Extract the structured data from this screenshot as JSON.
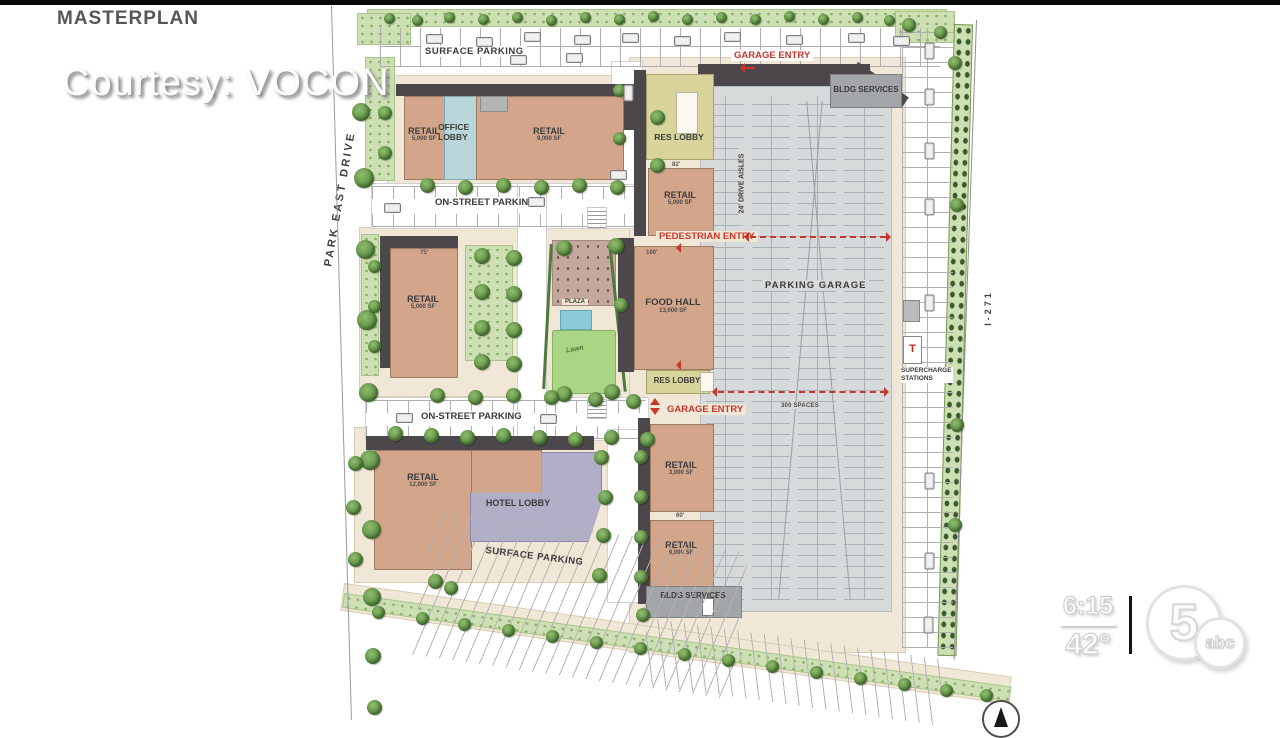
{
  "broadcast": {
    "title": "MASTERPLAN",
    "courtesy": "Courtesy: VOCON",
    "time": "6:15",
    "temperature": "42°",
    "station": {
      "channel": "5",
      "network": "abc"
    }
  },
  "plan": {
    "streets": {
      "west": "PARK EAST DRIVE",
      "east": "I-271"
    },
    "labels": {
      "surface_parking_top": "SURFACE PARKING",
      "surface_parking_bottom": "SURFACE PARKING",
      "on_street_parking_upper": "ON-STREET PARKING",
      "on_street_parking_lower": "ON-STREET PARKING",
      "parking_garage": "PARKING GARAGE",
      "drive_aisles": "24' DRIVE AISLES",
      "spaces": "300 SPACES",
      "supercharge_line1": "SUPERCHARGE",
      "supercharge_line2": "STATIONS",
      "plaza": "PLAZA",
      "lawn": "Lawn"
    },
    "entries": {
      "garage_top": "GARAGE ENTRY",
      "garage_mid": "GARAGE ENTRY",
      "pedestrian": "PEDESTRIAN ENTRY"
    },
    "buildings": {
      "retail_nw": {
        "name": "RETAIL",
        "area": "5,000 SF"
      },
      "office_lobby": {
        "name": "OFFICE LOBBY"
      },
      "retail_ne": {
        "name": "RETAIL",
        "area": "9,000 SF"
      },
      "res_lobby_top": {
        "name": "RES LOBBY"
      },
      "retail_e": {
        "name": "RETAIL",
        "area": "5,000 SF"
      },
      "retail_w": {
        "name": "RETAIL",
        "area": "5,000 SF"
      },
      "food_hall": {
        "name": "FOOD HALL",
        "area": "13,000 SF"
      },
      "res_lobby_mid": {
        "name": "RES LOBBY"
      },
      "retail_s1": {
        "name": "RETAIL",
        "area": "3,000 SF"
      },
      "retail_s2": {
        "name": "RETAIL",
        "area": "9,000 SF"
      },
      "retail_sw": {
        "name": "RETAIL",
        "area": "12,000 SF"
      },
      "hotel_lobby": {
        "name": "HOTEL LOBBY"
      },
      "bldg_services_ne": {
        "name": "BLDG SERVICES"
      },
      "bldg_services_s": {
        "name": "BLDG SERVICES"
      }
    },
    "dims": {
      "food_hall_w": "100'",
      "res_lobby_w": "82'",
      "retail_w_w": "75'",
      "retail_s_gap": "60'"
    },
    "colors": {
      "building_tan": "#d3a68b",
      "lobby_blue": "#b9d6da",
      "lobby_yellow": "#d9d49b",
      "lobby_purple": "#b1aec8",
      "roof_dark": "#4b474a",
      "garage_gray": "#d7dadb",
      "services_gray": "#a2a6a9",
      "landscape_green": "#cde0b4",
      "lawn_green": "#aad584",
      "pool_blue": "#8ecbd8",
      "plaza_brown": "#c4a89d",
      "sidewalk_cream": "#f0e7d6",
      "entry_red": "#c8372d"
    }
  }
}
